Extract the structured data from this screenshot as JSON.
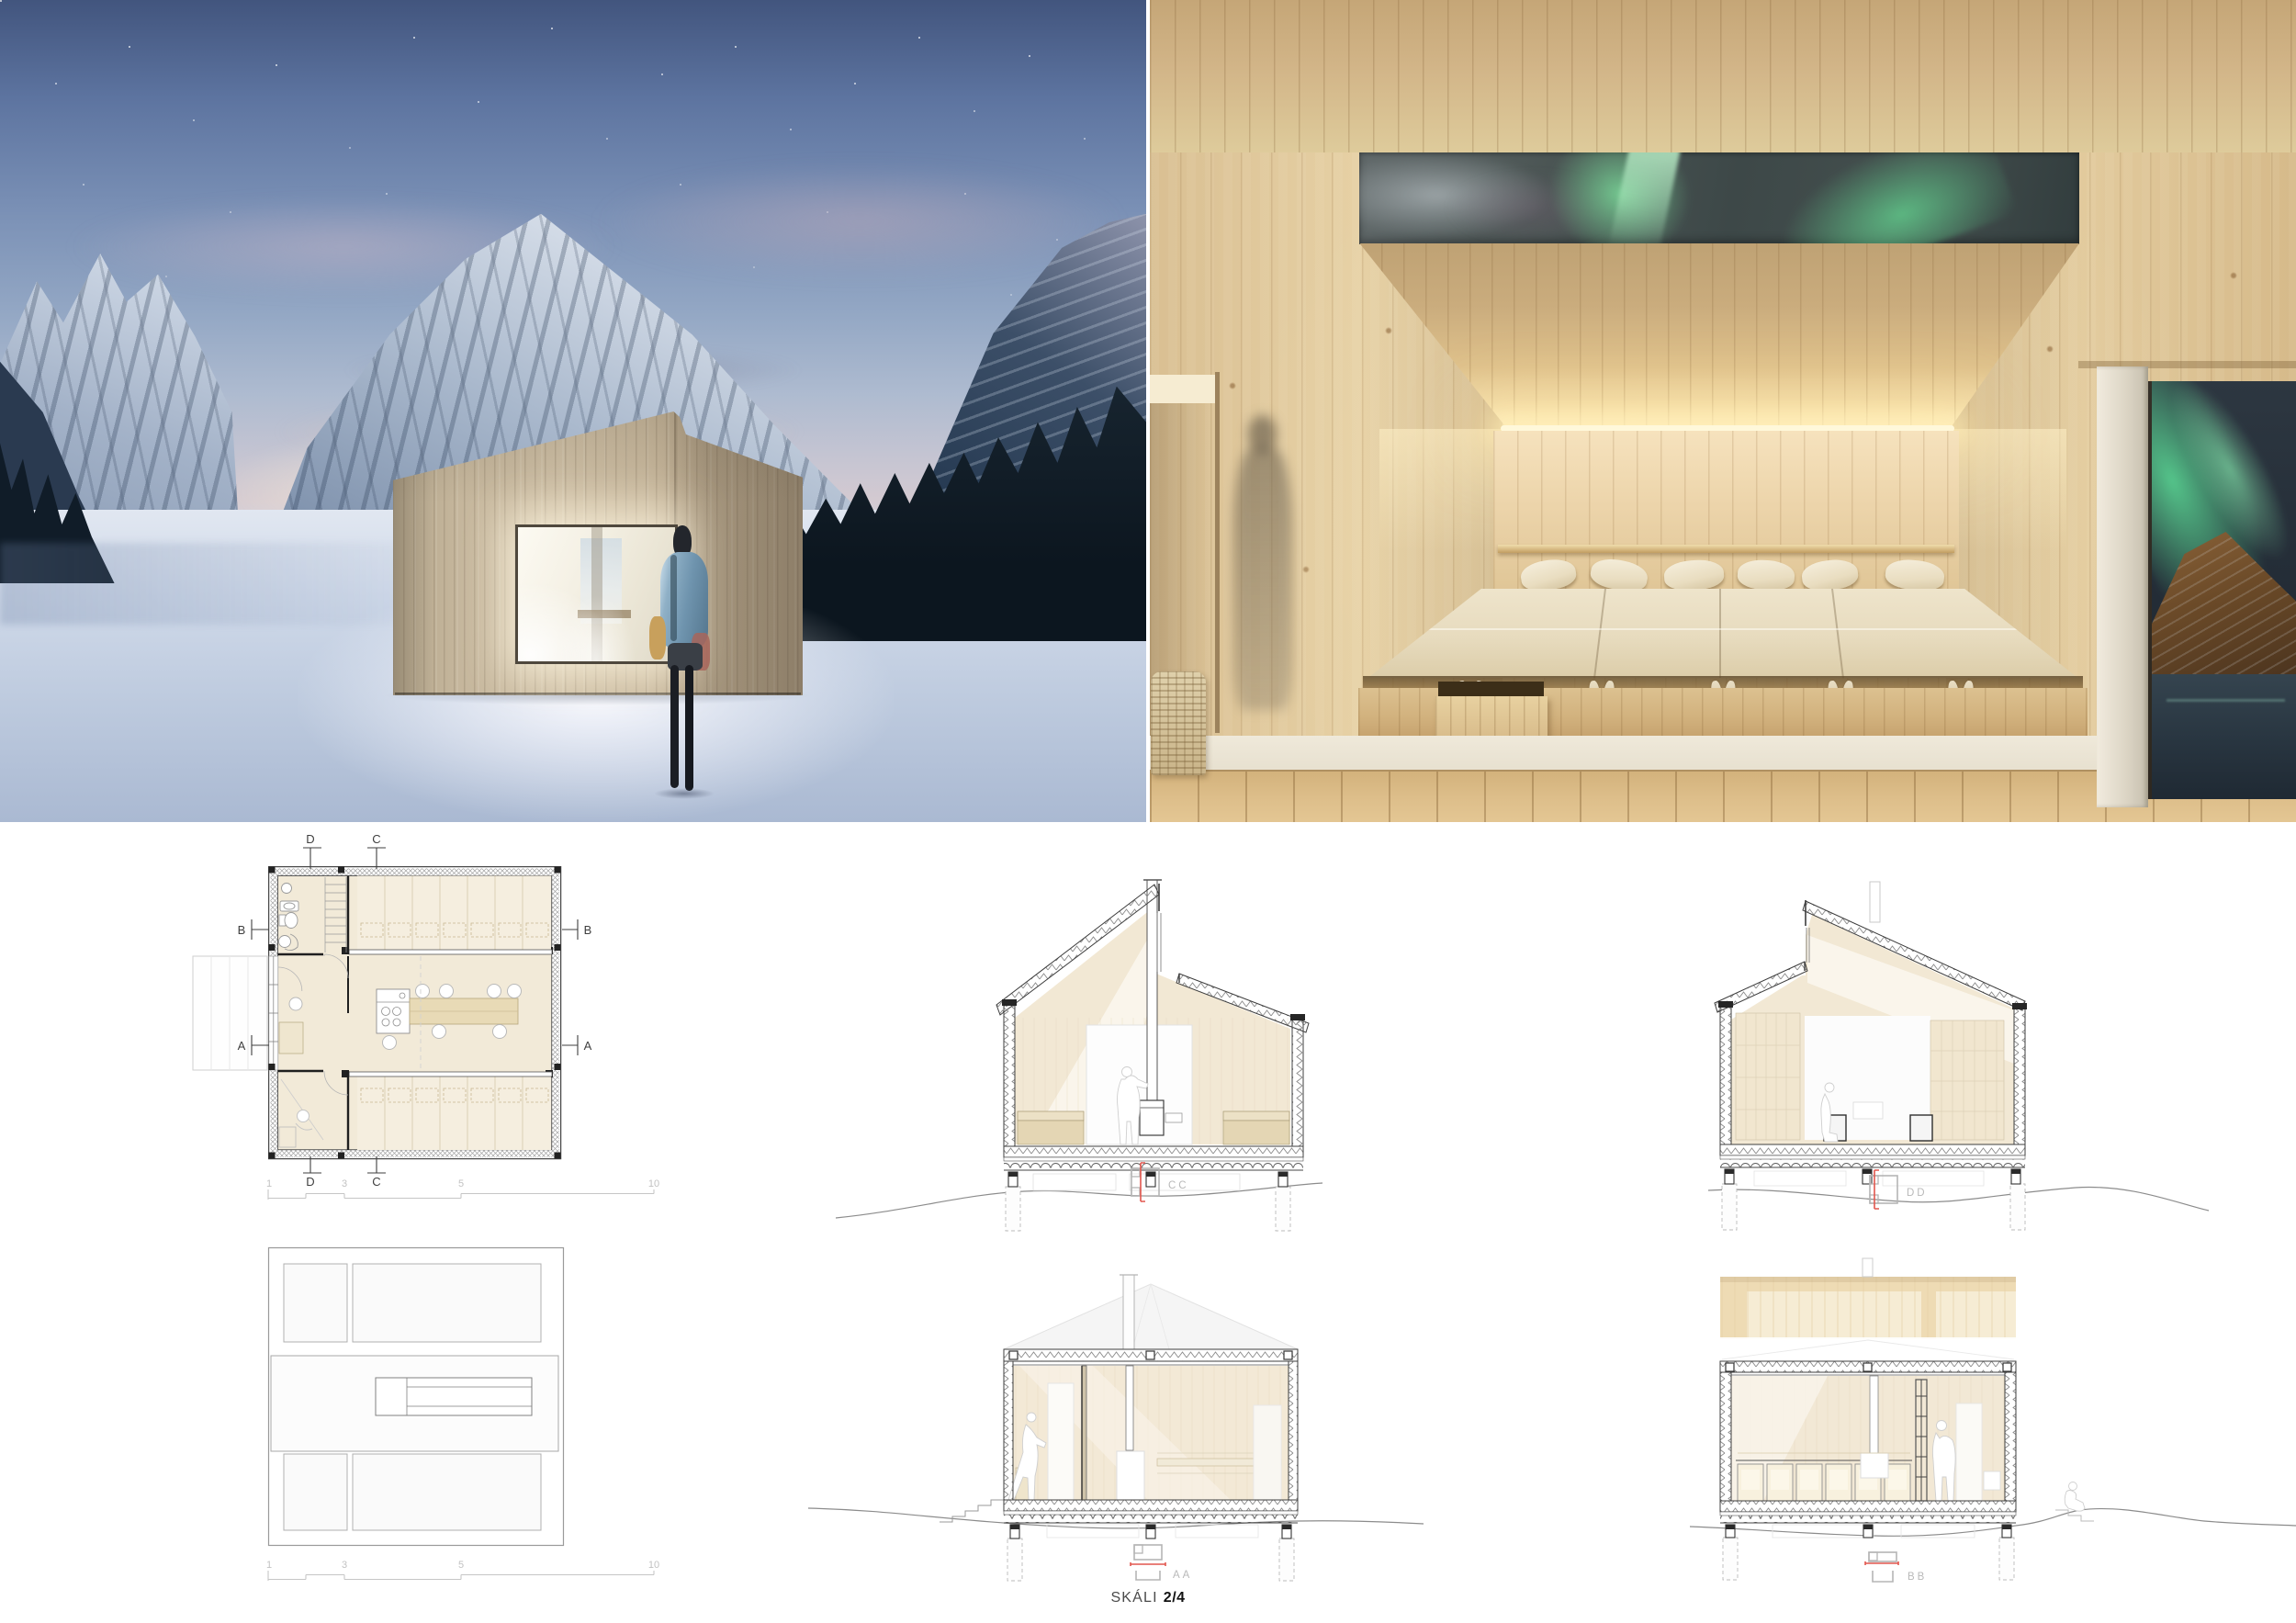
{
  "floor_plan": {
    "markers": {
      "a": "A",
      "b": "B",
      "c": "C",
      "d": "D"
    }
  },
  "drawings": {
    "scale_ticks": [
      "1",
      "3",
      "5",
      "10"
    ]
  },
  "sections": {
    "cc": {
      "label": "CC"
    },
    "dd": {
      "label": "DD"
    },
    "aa": {
      "label": "AA"
    },
    "bb": {
      "label": "BB"
    }
  },
  "caption": {
    "project": "SKÁLI",
    "sheet": "2/4"
  },
  "colors": {
    "accent_red": "#e2574e",
    "drawing_line": "#3f3f3f",
    "drawing_gray": "#b5b5b5",
    "plan_floor": "#f2ead8",
    "wood_light": "#e3cda2",
    "aurora_green": "#6fd096",
    "night_sky": "#3c474d",
    "snow": "#ccd8e8"
  }
}
